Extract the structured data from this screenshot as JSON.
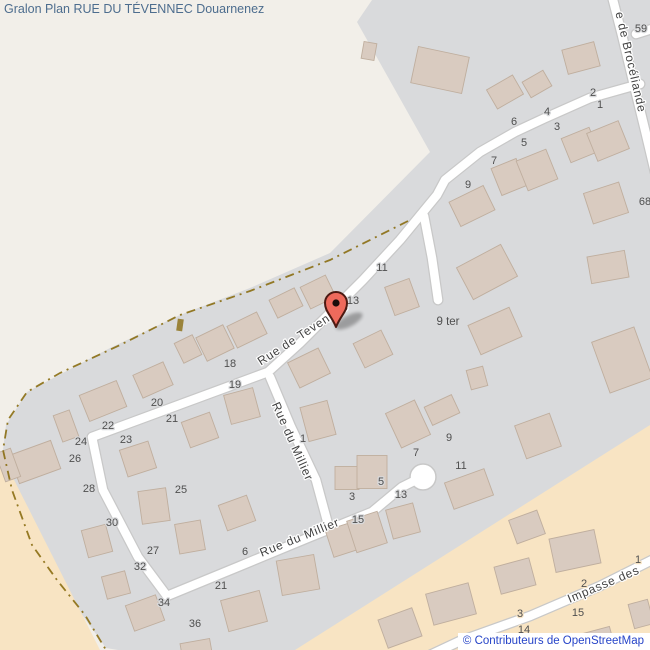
{
  "title": "Gralon Plan RUE DU TÉVENNEC Douarnenez",
  "attribution": "© Contributeurs de OpenStreetMap",
  "colors": {
    "land": "#f2efe9",
    "residential": "#d9dadc",
    "construction_zone": "#f8e4c3",
    "building_fill": "#d9cbc0",
    "building_stroke": "#bfae9e",
    "road_fill": "#ffffff",
    "road_casing": "#c8c8c8",
    "path_dashed": "#8a6d11",
    "marker_red": "#ee6a5c",
    "title_text": "#4d6d8e",
    "attribution_text": "#2644c8",
    "label_text": "#4f4f4f"
  },
  "streets": {
    "tevennec": "Rue de Tevennec",
    "millier_vertical": "Rue du Millier",
    "millier_horizontal": "Rue du Millier",
    "broceliande": "e de Brocéliande",
    "impasse": "Impasse des",
    "nine_ter": "9 ter"
  },
  "house_numbers": [
    {
      "t": "59",
      "x": 641,
      "y": 32,
      "z": "g"
    },
    {
      "t": "2",
      "x": 593,
      "y": 96,
      "z": "g"
    },
    {
      "t": "1",
      "x": 600,
      "y": 108,
      "z": "g"
    },
    {
      "t": "4",
      "x": 547,
      "y": 115,
      "z": "g"
    },
    {
      "t": "3",
      "x": 557,
      "y": 130,
      "z": "g"
    },
    {
      "t": "6",
      "x": 514,
      "y": 125,
      "z": "g"
    },
    {
      "t": "5",
      "x": 524,
      "y": 146,
      "z": "g"
    },
    {
      "t": "7",
      "x": 494,
      "y": 164,
      "z": "g"
    },
    {
      "t": "9",
      "x": 468,
      "y": 188,
      "z": "g"
    },
    {
      "t": "68",
      "x": 645,
      "y": 205,
      "z": "g"
    },
    {
      "t": "11",
      "x": 382,
      "y": 271,
      "z": "g"
    },
    {
      "t": "13",
      "x": 353,
      "y": 304,
      "z": "g"
    },
    {
      "t": "18",
      "x": 230,
      "y": 367,
      "z": "g"
    },
    {
      "t": "19",
      "x": 235,
      "y": 388,
      "z": "g"
    },
    {
      "t": "20",
      "x": 157,
      "y": 406,
      "z": "g"
    },
    {
      "t": "21",
      "x": 172,
      "y": 422,
      "z": "g"
    },
    {
      "t": "22",
      "x": 108,
      "y": 429,
      "z": "g"
    },
    {
      "t": "23",
      "x": 126,
      "y": 443,
      "z": "g"
    },
    {
      "t": "24",
      "x": 81,
      "y": 445,
      "z": "g"
    },
    {
      "t": "26",
      "x": 75,
      "y": 462,
      "z": "g"
    },
    {
      "t": "28",
      "x": 89,
      "y": 492,
      "z": "g"
    },
    {
      "t": "25",
      "x": 181,
      "y": 493,
      "z": "g"
    },
    {
      "t": "30",
      "x": 112,
      "y": 526,
      "z": "g"
    },
    {
      "t": "27",
      "x": 153,
      "y": 554,
      "z": "g"
    },
    {
      "t": "32",
      "x": 140,
      "y": 570,
      "z": "g"
    },
    {
      "t": "34",
      "x": 164,
      "y": 606,
      "z": "g"
    },
    {
      "t": "36",
      "x": 195,
      "y": 627,
      "z": "g"
    },
    {
      "t": "1",
      "x": 303,
      "y": 442,
      "z": "g"
    },
    {
      "t": "9",
      "x": 449,
      "y": 441,
      "z": "g"
    },
    {
      "t": "7",
      "x": 416,
      "y": 456,
      "z": "g"
    },
    {
      "t": "11",
      "x": 461,
      "y": 469,
      "z": "g"
    },
    {
      "t": "5",
      "x": 381,
      "y": 485,
      "z": "g"
    },
    {
      "t": "3",
      "x": 352,
      "y": 500,
      "z": "g"
    },
    {
      "t": "13",
      "x": 401,
      "y": 498,
      "z": "g"
    },
    {
      "t": "15",
      "x": 358,
      "y": 523,
      "z": "g"
    },
    {
      "t": "6",
      "x": 245,
      "y": 555,
      "z": "g"
    },
    {
      "t": "21",
      "x": 221,
      "y": 589,
      "z": "g"
    },
    {
      "t": "1",
      "x": 638,
      "y": 563,
      "z": "o"
    },
    {
      "t": "2",
      "x": 584,
      "y": 587,
      "z": "o"
    },
    {
      "t": "15",
      "x": 578,
      "y": 616,
      "z": "o"
    },
    {
      "t": "3",
      "x": 520,
      "y": 617,
      "z": "o"
    },
    {
      "t": "14",
      "x": 524,
      "y": 633,
      "z": "o"
    },
    {
      "t": "4",
      "x": 465,
      "y": 642,
      "z": "o"
    }
  ]
}
